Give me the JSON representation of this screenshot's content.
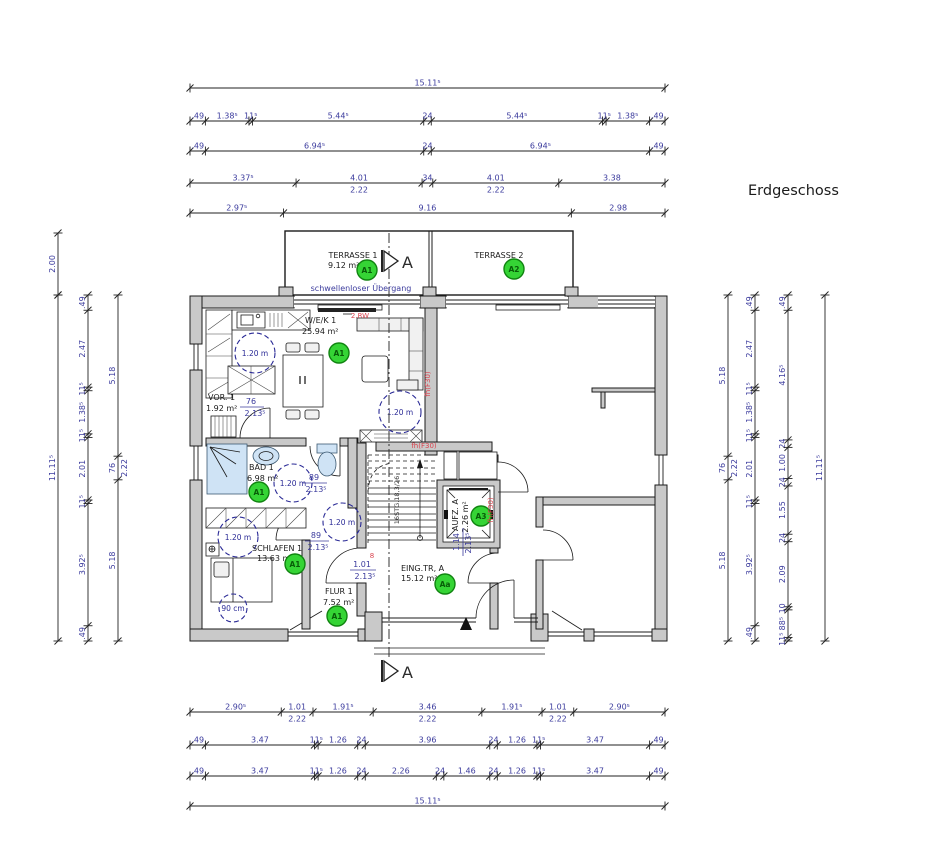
{
  "title": "Erdgeschoss",
  "colors": {
    "dim_text": "#3b3b9d",
    "wall_fill": "#c9c9c9",
    "badge_fill": "#35d435",
    "badge_stroke": "#118411",
    "badge_text": "#085c08",
    "fire_red": "#d9434e",
    "fixture_blue": "#cfe3f5"
  },
  "plan": {
    "rooms": {
      "terrasse1": {
        "name": "TERRASSE 1",
        "area": "9.12 m²",
        "badge": "A1"
      },
      "terrasse2": {
        "name": "TERRASSE 2",
        "badge": "A2"
      },
      "wek": {
        "name": "W/E/K 1",
        "area": "25.94 m²",
        "badge": "A1"
      },
      "vor": {
        "name": "VOR. 1",
        "area": "1.92 m²"
      },
      "bad": {
        "name": "BAD 1",
        "area": "6.98 m²",
        "badge": "A1"
      },
      "schlafen": {
        "name": "SCHLAFEN 1",
        "area": "13.63 m²",
        "badge": "A1"
      },
      "flur": {
        "name": "FLUR 1",
        "area": "7.52 m²",
        "badge": "A1"
      },
      "eingtr": {
        "name": "EING.TR, A",
        "area": "15.12 m²",
        "badge": "Aa"
      },
      "aufzug": {
        "name": "AUFZ. A",
        "area": "2.26 m²",
        "badge": "A3"
      }
    },
    "notes": {
      "transition": "schwellenloser Übergang",
      "rescue": "2.RW",
      "fire": "fh(F30)",
      "stair": "16STG.18,3/26",
      "circle": "1.20 m",
      "circle_small": "90 cm",
      "section": "A",
      "door_symbol": "8"
    },
    "door_dims": {
      "vor": {
        "w": "76",
        "h": "2.13⁵"
      },
      "bad": {
        "w": "89",
        "h": "2.13⁵"
      },
      "hall": {
        "w": "89",
        "h": "2.13⁵"
      },
      "flur": {
        "w": "1.01",
        "h": "2.13⁵"
      },
      "lift": {
        "w": "1.14",
        "h": "2.13⁵"
      }
    }
  },
  "dims": {
    "top": [
      [
        {
          "m": 15.115,
          "t": "15.11⁵"
        }
      ],
      [
        {
          "m": 0.49,
          "t": ".49"
        },
        {
          "m": 1.385,
          "t": "1.38⁵"
        },
        {
          "m": 0.115,
          "t": "11⁵"
        },
        {
          "m": 5.445,
          "t": "5.44⁵"
        },
        {
          "m": 0.24,
          "t": "24"
        },
        {
          "m": 5.445,
          "t": "5.44⁵"
        },
        {
          "m": 0.115,
          "t": "11⁵"
        },
        {
          "m": 1.385,
          "t": "1.38⁵"
        },
        {
          "m": 0.49,
          "t": ".49"
        }
      ],
      [
        {
          "m": 0.49,
          "t": ".49"
        },
        {
          "m": 6.945,
          "t": "6.94⁵"
        },
        {
          "m": 0.24,
          "t": "24"
        },
        {
          "m": 6.945,
          "t": "6.94⁵"
        },
        {
          "m": 0.49,
          "t": ".49"
        }
      ],
      [
        {
          "m": 3.375,
          "t": "3.37⁵"
        },
        {
          "m": 4.01,
          "t": "4.01",
          "t2": "2.22"
        },
        {
          "m": 0.34,
          "t": "34"
        },
        {
          "m": 4.01,
          "t": "4.01",
          "t2": "2.22"
        },
        {
          "m": 3.38,
          "t": "3.38"
        }
      ],
      [
        {
          "m": 2.975,
          "t": "2.97⁵"
        },
        {
          "m": 9.16,
          "t": "9.16"
        },
        {
          "m": 2.98,
          "t": "2.98"
        }
      ]
    ],
    "bottom": [
      [
        {
          "m": 2.905,
          "t": "2.90⁵"
        },
        {
          "m": 1.01,
          "t": "1.01",
          "t2": "2.22"
        },
        {
          "m": 1.915,
          "t": "1.91⁵"
        },
        {
          "m": 3.46,
          "t": "3.46",
          "t2": "2.22"
        },
        {
          "m": 1.915,
          "t": "1.91⁵"
        },
        {
          "m": 1.01,
          "t": "1.01",
          "t2": "2.22"
        },
        {
          "m": 2.905,
          "t": "2.90⁵"
        }
      ],
      [
        {
          "m": 0.49,
          "t": ".49"
        },
        {
          "m": 3.47,
          "t": "3.47"
        },
        {
          "m": 0.115,
          "t": "11⁵"
        },
        {
          "m": 1.26,
          "t": "1.26"
        },
        {
          "m": 0.24,
          "t": "24"
        },
        {
          "m": 3.96,
          "t": "3.96"
        },
        {
          "m": 0.24,
          "t": "24"
        },
        {
          "m": 1.26,
          "t": "1.26"
        },
        {
          "m": 0.115,
          "t": "11⁵"
        },
        {
          "m": 3.47,
          "t": "3.47"
        },
        {
          "m": 0.49,
          "t": ".49"
        }
      ],
      [
        {
          "m": 0.49,
          "t": ".49"
        },
        {
          "m": 3.47,
          "t": "3.47"
        },
        {
          "m": 0.115,
          "t": "11⁵"
        },
        {
          "m": 1.26,
          "t": "1.26"
        },
        {
          "m": 0.24,
          "t": "24"
        },
        {
          "m": 2.26,
          "t": "2.26"
        },
        {
          "m": 0.24,
          "t": "24"
        },
        {
          "m": 1.46,
          "t": "1.46"
        },
        {
          "m": 0.24,
          "t": "24"
        },
        {
          "m": 1.26,
          "t": "1.26"
        },
        {
          "m": 0.115,
          "t": "11⁵"
        },
        {
          "m": 3.47,
          "t": "3.47"
        },
        {
          "m": 0.49,
          "t": ".49"
        }
      ],
      [
        {
          "m": 15.115,
          "t": "15.11⁵"
        }
      ]
    ],
    "left": [
      [
        {
          "m": 2.0,
          "t": "2.00"
        }
      ],
      [
        {
          "m": 11.115,
          "t": "11.11⁵"
        }
      ],
      [
        {
          "m": 0.49,
          "t": ".49"
        },
        {
          "m": 2.47,
          "t": "2.47"
        },
        {
          "m": 0.115,
          "t": "11⁵"
        },
        {
          "m": 1.385,
          "t": "1.38⁵"
        },
        {
          "m": 0.115,
          "t": "11⁵"
        },
        {
          "m": 2.01,
          "t": "2.01"
        },
        {
          "m": 0.115,
          "t": "11⁵"
        },
        {
          "m": 3.925,
          "t": "3.92⁵"
        },
        {
          "m": 0.49,
          "t": ".49"
        }
      ],
      [
        {
          "m": 5.18,
          "t": "5.18"
        },
        {
          "m": 0.76,
          "t": "76",
          "t2": "2.22"
        },
        {
          "m": 5.18,
          "t": "5.18"
        }
      ]
    ],
    "right": [
      [
        {
          "m": 5.18,
          "t": "5.18"
        },
        {
          "m": 0.76,
          "t": "76",
          "t2": "2.22"
        },
        {
          "m": 5.18,
          "t": "5.18"
        }
      ],
      [
        {
          "m": 0.49,
          "t": ".49"
        },
        {
          "m": 2.47,
          "t": "2.47"
        },
        {
          "m": 0.115,
          "t": "11⁵"
        },
        {
          "m": 1.385,
          "t": "1.38⁵"
        },
        {
          "m": 0.115,
          "t": "11⁵"
        },
        {
          "m": 2.01,
          "t": "2.01"
        },
        {
          "m": 0.115,
          "t": "11⁵"
        },
        {
          "m": 3.925,
          "t": "3.92⁵"
        },
        {
          "m": 0.49,
          "t": ".49"
        }
      ],
      [
        {
          "m": 0.49,
          "t": ".49"
        },
        {
          "m": 4.165,
          "t": "4.16⁵"
        },
        {
          "m": 0.24,
          "t": "24"
        },
        {
          "m": 1.0,
          "t": "1.00"
        },
        {
          "m": 0.24,
          "t": "24"
        },
        {
          "m": 1.55,
          "t": "1.55"
        },
        {
          "m": 0.24,
          "t": "24"
        },
        {
          "m": 2.09,
          "t": "2.09"
        },
        {
          "m": 0.1,
          "t": "10"
        },
        {
          "m": 0.885,
          "t": "88⁵"
        },
        {
          "m": 0.115,
          "t": "11⁵"
        }
      ],
      [
        {
          "m": 11.115,
          "t": "11.11⁵"
        }
      ]
    ]
  }
}
